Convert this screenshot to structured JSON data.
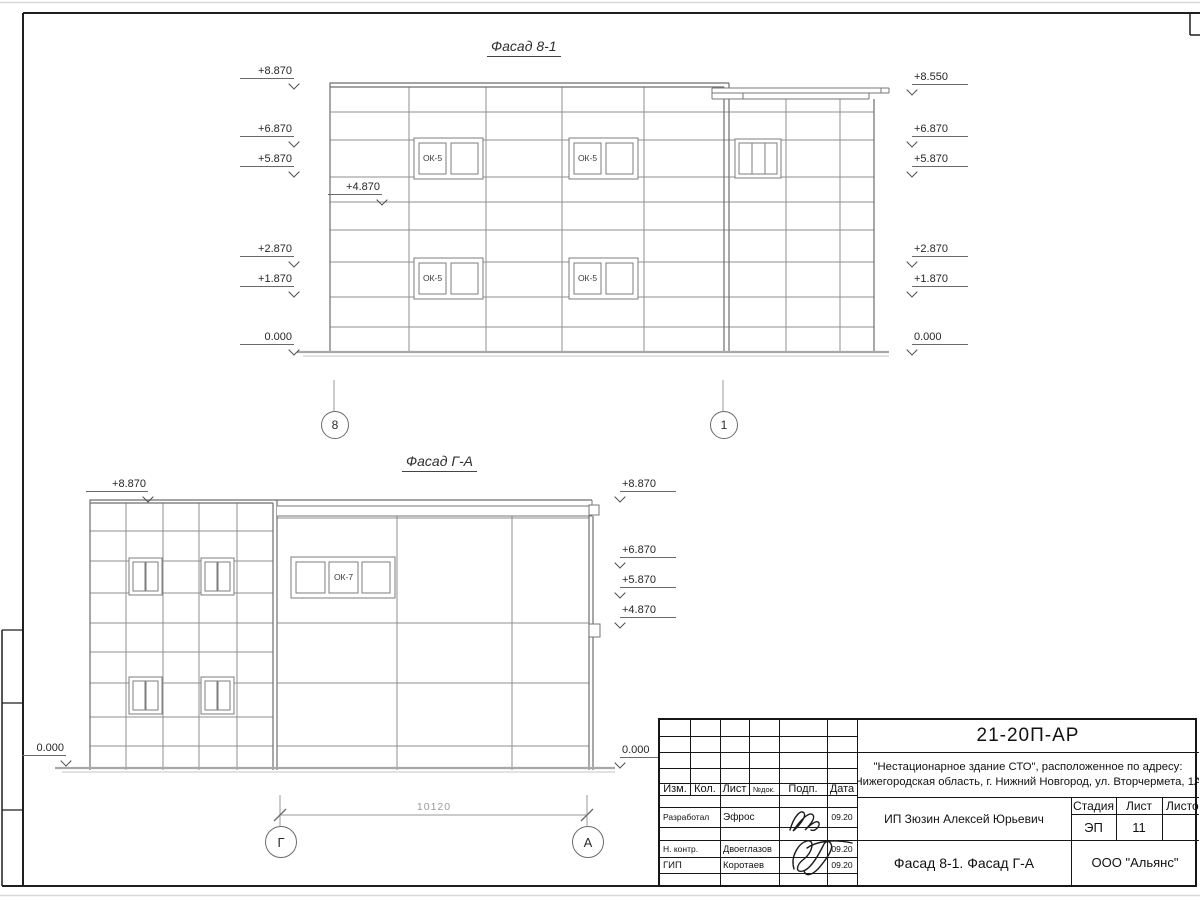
{
  "sheet": {
    "facade1": {
      "title": "Фасад 8-1",
      "window_label": "ОК-5",
      "axes": [
        "8",
        "1"
      ],
      "elev_left": [
        "+8.870",
        "+6.870",
        "+5.870",
        "+4.870",
        "+2.870",
        "+1.870",
        "0.000"
      ],
      "elev_right": [
        "+8.550",
        "+6.870",
        "+5.870",
        "+2.870",
        "+1.870",
        "0.000"
      ]
    },
    "facade2": {
      "title": "Фасад Г-А",
      "window_label": "ОК-7",
      "axes": [
        "Г",
        "А"
      ],
      "elev_left": [
        "+8.870",
        "0.000"
      ],
      "elev_right": [
        "+8.870",
        "+6.870",
        "+5.870",
        "+4.870",
        "0.000"
      ],
      "dimension": "10120"
    },
    "title_block": {
      "code": "21-20П-АР",
      "project_line1": "\"Нестационарное здание СТО\", расположенное по адресу:",
      "project_line2": "Нижегородская область, г. Нижний Новгород, ул. Вторчермета, 1А",
      "client": "ИП Зюзин Алексей Юрьевич",
      "sheet_title": "Фасад 8-1. Фасад Г-А",
      "company": "ООО \"Альянс\"",
      "header": {
        "izm": "Изм.",
        "kol": "Кол.",
        "list": "Лист",
        "ndok": "№док.",
        "podp": "Подп.",
        "data": "Дата"
      },
      "stage_label": "Стадия",
      "sheet_label": "Лист",
      "sheets_label": "Листов",
      "stage_value": "ЭП",
      "sheet_value": "11",
      "rows": [
        {
          "role": "Разработал",
          "name": "Эфрос",
          "date": "09.20"
        },
        {
          "role": "Н. контр.",
          "name": "Двоеглазов",
          "date": "09.20"
        },
        {
          "role": "ГИП",
          "name": "Коротаев",
          "date": "09.20"
        }
      ]
    },
    "colors": {
      "line_gray": "#8f8f8f",
      "outline_gray": "#6e6e6e",
      "ground_gray": "#a8a8a8",
      "frame_black": "#1f1f1f",
      "dim_gray": "#9a9a9a"
    }
  }
}
